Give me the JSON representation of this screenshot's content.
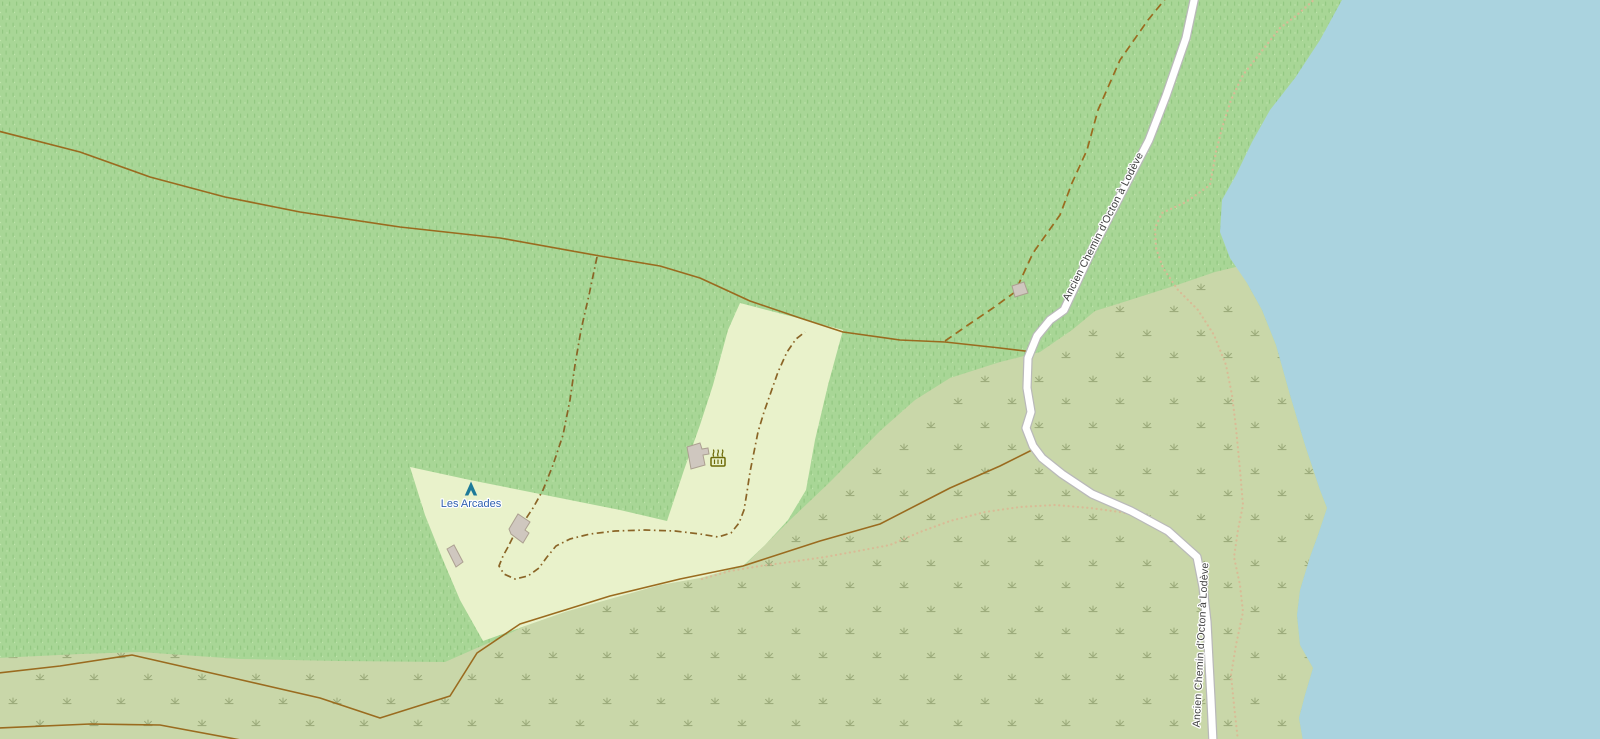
{
  "map": {
    "width": 1600,
    "height": 739,
    "palette": {
      "forest": "#a8d696",
      "forest_mark": "#8cc27b",
      "forest_light": "#c6e8b2",
      "meadow": "#e9f2cb",
      "scrub": "#c9d7a9",
      "scrub_mark": "#98a877",
      "water": "#aad3df",
      "track": "#9a6b1f",
      "path_dashdot": "#8a6426",
      "path_dotted": "#d9bb96",
      "road_fill": "#ffffff",
      "road_casing": "#b9b9b9",
      "building_fill": "#cfc7bf",
      "building_stroke": "#aca091",
      "label_road": "#3d3d3d",
      "label_poi": "#3061b0",
      "icon_camp": "#1d7a99",
      "icon_bbq": "#6d6a08",
      "halo": "#ffffff"
    },
    "areas": {
      "water": [
        [
          1343,
          -2
        ],
        [
          1320,
          40
        ],
        [
          1295,
          78
        ],
        [
          1270,
          110
        ],
        [
          1252,
          142
        ],
        [
          1236,
          175
        ],
        [
          1222,
          200
        ],
        [
          1220,
          232
        ],
        [
          1230,
          258
        ],
        [
          1247,
          283
        ],
        [
          1262,
          310
        ],
        [
          1276,
          345
        ],
        [
          1290,
          395
        ],
        [
          1305,
          445
        ],
        [
          1320,
          490
        ],
        [
          1327,
          508
        ],
        [
          1318,
          535
        ],
        [
          1310,
          557
        ],
        [
          1300,
          590
        ],
        [
          1297,
          615
        ],
        [
          1300,
          645
        ],
        [
          1313,
          668
        ],
        [
          1305,
          695
        ],
        [
          1299,
          718
        ],
        [
          1303,
          741
        ],
        [
          1602,
          741
        ],
        [
          1602,
          -2
        ]
      ],
      "scrub": [
        [
          -2,
          658
        ],
        [
          80,
          654
        ],
        [
          140,
          652
        ],
        [
          240,
          659
        ],
        [
          340,
          661
        ],
        [
          445,
          662
        ],
        [
          470,
          651
        ],
        [
          500,
          638
        ],
        [
          525,
          626
        ],
        [
          565,
          612
        ],
        [
          610,
          599
        ],
        [
          660,
          584
        ],
        [
          700,
          577
        ],
        [
          743,
          567
        ],
        [
          790,
          520
        ],
        [
          830,
          482
        ],
        [
          880,
          431
        ],
        [
          915,
          400
        ],
        [
          950,
          378
        ],
        [
          1000,
          362
        ],
        [
          1040,
          352
        ],
        [
          1072,
          330
        ],
        [
          1095,
          311
        ],
        [
          1130,
          300
        ],
        [
          1180,
          284
        ],
        [
          1215,
          272
        ],
        [
          1240,
          266
        ],
        [
          1247,
          283
        ],
        [
          1262,
          310
        ],
        [
          1276,
          345
        ],
        [
          1290,
          395
        ],
        [
          1305,
          445
        ],
        [
          1320,
          490
        ],
        [
          1327,
          508
        ],
        [
          1318,
          535
        ],
        [
          1310,
          557
        ],
        [
          1300,
          590
        ],
        [
          1297,
          615
        ],
        [
          1300,
          645
        ],
        [
          1313,
          668
        ],
        [
          1305,
          695
        ],
        [
          1299,
          718
        ],
        [
          1303,
          741
        ],
        [
          -2,
          741
        ]
      ],
      "meadow": [
        [
          410,
          467
        ],
        [
          470,
          480
        ],
        [
          530,
          492
        ],
        [
          575,
          501
        ],
        [
          620,
          510
        ],
        [
          667,
          521
        ],
        [
          684,
          470
        ],
        [
          700,
          425
        ],
        [
          713,
          385
        ],
        [
          728,
          330
        ],
        [
          740,
          303
        ],
        [
          790,
          316
        ],
        [
          843,
          330
        ],
        [
          828,
          385
        ],
        [
          815,
          440
        ],
        [
          806,
          490
        ],
        [
          788,
          520
        ],
        [
          765,
          545
        ],
        [
          743,
          566
        ],
        [
          700,
          578
        ],
        [
          660,
          585
        ],
        [
          610,
          599
        ],
        [
          565,
          612
        ],
        [
          525,
          626
        ],
        [
          483,
          641
        ],
        [
          460,
          600
        ],
        [
          443,
          560
        ],
        [
          425,
          515
        ]
      ]
    },
    "lines": [
      {
        "name": "track-upper",
        "style": "track",
        "points": [
          [
            -2,
            131
          ],
          [
            80,
            152
          ],
          [
            150,
            177
          ],
          [
            225,
            197
          ],
          [
            300,
            212
          ],
          [
            400,
            227
          ],
          [
            500,
            238
          ],
          [
            600,
            256
          ],
          [
            660,
            266
          ],
          [
            700,
            278
          ],
          [
            750,
            301
          ],
          [
            800,
            318
          ],
          [
            843,
            332
          ],
          [
            900,
            340
          ],
          [
            945,
            342
          ],
          [
            1000,
            348
          ],
          [
            1033,
            352
          ]
        ]
      },
      {
        "name": "track-lower",
        "style": "track",
        "points": [
          [
            -2,
            673
          ],
          [
            60,
            666
          ],
          [
            132,
            655
          ],
          [
            233,
            678
          ],
          [
            320,
            698
          ],
          [
            380,
            718
          ],
          [
            450,
            696
          ],
          [
            477,
            653
          ],
          [
            520,
            624
          ],
          [
            610,
            596
          ],
          [
            680,
            579
          ],
          [
            743,
            566
          ],
          [
            820,
            541
          ],
          [
            880,
            524
          ],
          [
            950,
            488
          ],
          [
            1000,
            466
          ],
          [
            1032,
            450
          ]
        ]
      },
      {
        "name": "track-bottom",
        "style": "track",
        "points": [
          [
            -2,
            728
          ],
          [
            90,
            724
          ],
          [
            160,
            725
          ],
          [
            246,
            741
          ]
        ]
      },
      {
        "name": "path-dashed-northeast",
        "style": "dashed",
        "points": [
          [
            945,
            341
          ],
          [
            968,
            325
          ],
          [
            993,
            308
          ],
          [
            1015,
            292
          ],
          [
            1033,
            253
          ],
          [
            1060,
            215
          ],
          [
            1072,
            183
          ],
          [
            1087,
            150
          ],
          [
            1098,
            110
          ],
          [
            1120,
            60
          ],
          [
            1148,
            20
          ],
          [
            1166,
            -2
          ]
        ]
      },
      {
        "name": "path-dashdot-north-branch",
        "style": "dashdot",
        "points": [
          [
            597,
            257
          ],
          [
            589,
            295
          ],
          [
            581,
            330
          ],
          [
            575,
            365
          ],
          [
            570,
            400
          ],
          [
            563,
            435
          ],
          [
            553,
            465
          ],
          [
            543,
            490
          ],
          [
            533,
            508
          ],
          [
            523,
            523
          ],
          [
            513,
            537
          ],
          [
            508,
            547
          ]
        ]
      },
      {
        "name": "path-dashdot-meadow-loop",
        "style": "dashdot",
        "points": [
          [
            508,
            547
          ],
          [
            503,
            556
          ],
          [
            499,
            566
          ],
          [
            504,
            574
          ],
          [
            515,
            579
          ],
          [
            528,
            576
          ],
          [
            539,
            568
          ],
          [
            547,
            557
          ],
          [
            556,
            546
          ],
          [
            570,
            539
          ],
          [
            590,
            534
          ],
          [
            615,
            531
          ],
          [
            645,
            530
          ],
          [
            675,
            531
          ],
          [
            700,
            534
          ],
          [
            718,
            537
          ],
          [
            731,
            533
          ],
          [
            739,
            523
          ],
          [
            744,
            510
          ],
          [
            747,
            492
          ],
          [
            750,
            472
          ],
          [
            754,
            452
          ],
          [
            758,
            432
          ],
          [
            764,
            412
          ],
          [
            771,
            392
          ],
          [
            778,
            372
          ],
          [
            787,
            352
          ],
          [
            796,
            339
          ],
          [
            805,
            332
          ]
        ]
      },
      {
        "name": "path-dotted-lakeside",
        "style": "dotted",
        "points": [
          [
            1316,
            -2
          ],
          [
            1297,
            15
          ],
          [
            1280,
            28
          ],
          [
            1261,
            52
          ],
          [
            1243,
            75
          ],
          [
            1231,
            100
          ],
          [
            1222,
            128
          ],
          [
            1216,
            152
          ],
          [
            1210,
            185
          ],
          [
            1186,
            202
          ],
          [
            1162,
            213
          ],
          [
            1155,
            228
          ],
          [
            1156,
            248
          ],
          [
            1163,
            268
          ],
          [
            1178,
            290
          ],
          [
            1198,
            310
          ],
          [
            1214,
            335
          ],
          [
            1226,
            365
          ],
          [
            1232,
            395
          ],
          [
            1236,
            428
          ],
          [
            1240,
            470
          ],
          [
            1243,
            505
          ],
          [
            1238,
            530
          ],
          [
            1234,
            557
          ],
          [
            1240,
            585
          ],
          [
            1243,
            612
          ],
          [
            1236,
            645
          ],
          [
            1231,
            675
          ],
          [
            1234,
            705
          ],
          [
            1238,
            741
          ]
        ]
      },
      {
        "name": "path-dotted-scrub",
        "style": "dotted",
        "points": [
          [
            702,
            579
          ],
          [
            730,
            571
          ],
          [
            760,
            566
          ],
          [
            790,
            562
          ],
          [
            825,
            557
          ],
          [
            858,
            551
          ],
          [
            890,
            545
          ],
          [
            920,
            532
          ],
          [
            950,
            521
          ],
          [
            985,
            512
          ],
          [
            1020,
            507
          ],
          [
            1055,
            505
          ],
          [
            1090,
            508
          ],
          [
            1120,
            512
          ],
          [
            1150,
            518
          ]
        ]
      },
      {
        "name": "road-ancien-chemin",
        "style": "road",
        "points": [
          [
            1195,
            -4
          ],
          [
            1186,
            38
          ],
          [
            1166,
            96
          ],
          [
            1149,
            140
          ],
          [
            1120,
            196
          ],
          [
            1092,
            250
          ],
          [
            1064,
            310
          ],
          [
            1050,
            320
          ],
          [
            1037,
            336
          ],
          [
            1028,
            358
          ],
          [
            1027,
            388
          ],
          [
            1031,
            412
          ],
          [
            1026,
            428
          ],
          [
            1033,
            446
          ],
          [
            1042,
            458
          ],
          [
            1062,
            474
          ],
          [
            1092,
            494
          ],
          [
            1131,
            511
          ],
          [
            1168,
            531
          ],
          [
            1197,
            557
          ],
          [
            1203,
            587
          ],
          [
            1207,
            622
          ],
          [
            1209,
            662
          ],
          [
            1211,
            700
          ],
          [
            1213,
            743
          ]
        ]
      }
    ],
    "buildings": [
      {
        "name": "building-campsite-main",
        "points": [
          [
            509,
            529
          ],
          [
            518,
            514
          ],
          [
            530,
            522
          ],
          [
            525,
            530
          ],
          [
            529,
            533
          ],
          [
            523,
            543
          ],
          [
            511,
            534
          ]
        ]
      },
      {
        "name": "building-campsite-small",
        "points": [
          [
            447,
            549
          ],
          [
            454,
            545
          ],
          [
            463,
            562
          ],
          [
            456,
            567
          ]
        ]
      },
      {
        "name": "building-bbq-hut",
        "points": [
          [
            687,
            447
          ],
          [
            700,
            443
          ],
          [
            702,
            449
          ],
          [
            708,
            448
          ],
          [
            709,
            454
          ],
          [
            703,
            455
          ],
          [
            705,
            465
          ],
          [
            691,
            469
          ]
        ]
      },
      {
        "name": "building-roadside-hut",
        "points": [
          [
            1012,
            286
          ],
          [
            1024,
            282
          ],
          [
            1028,
            293
          ],
          [
            1015,
            297
          ]
        ]
      }
    ],
    "icons": [
      {
        "name": "campsite-icon",
        "kind": "tent",
        "x": 471,
        "y": 489
      },
      {
        "name": "bbq-icon",
        "kind": "bbq",
        "x": 718,
        "y": 460
      }
    ],
    "labels": [
      {
        "name": "road-label-upper",
        "text": "Ancien Chemin d'Octon à Lodève",
        "x": 1106,
        "y": 228,
        "rotate": -63,
        "cls": "road"
      },
      {
        "name": "road-label-lower",
        "text": "Ancien Chemin d'Octon à Lodève",
        "x": 1204,
        "y": 645,
        "rotate": -87,
        "cls": "road"
      },
      {
        "name": "campsite-label",
        "text": "Les Arcades",
        "x": 471,
        "y": 507,
        "rotate": 0,
        "cls": "poi"
      }
    ]
  }
}
